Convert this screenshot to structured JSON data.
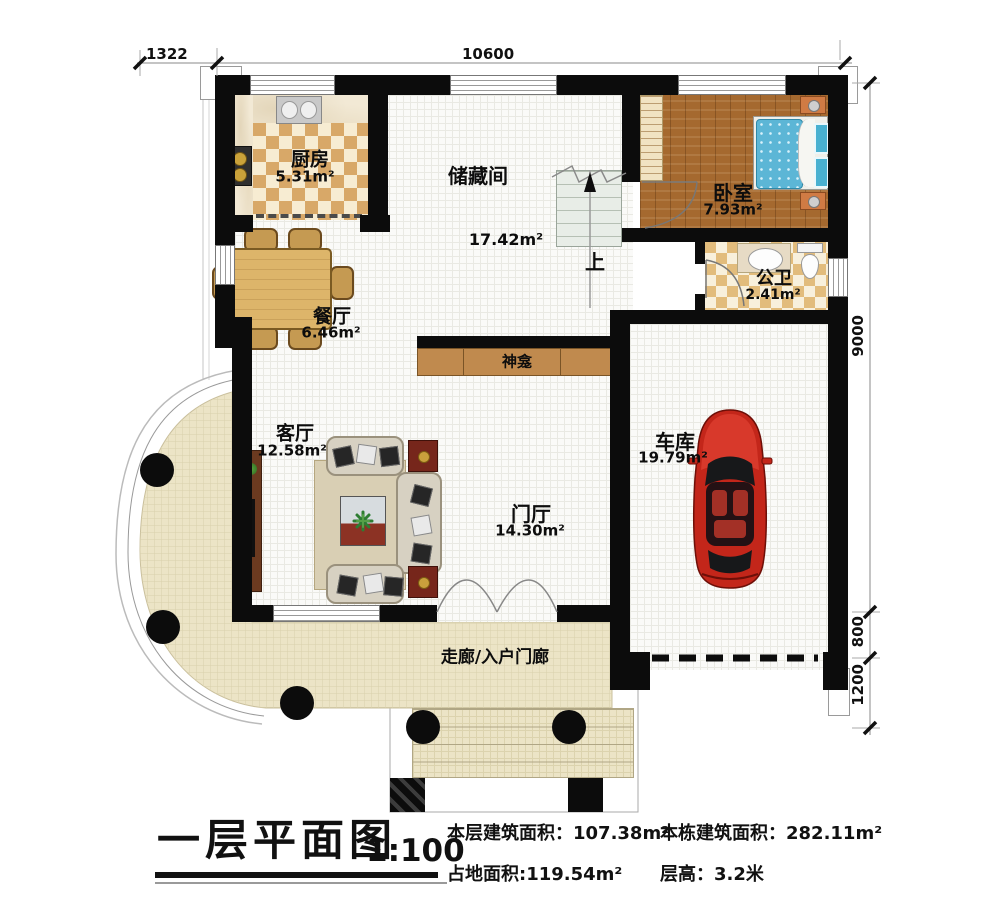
{
  "palette": {
    "wall": "#0c0c0c",
    "car_red": "#c3261a",
    "wood_floor": "#a5692f",
    "porch_cream": "#ece4c6",
    "kitchen_checker": "#d8a868",
    "bed_blue": "#5cb6d6"
  },
  "dimensions": {
    "left_top": "1322",
    "top": "10600",
    "right_main": "9000",
    "right_mid": "800",
    "right_bottom": "1200"
  },
  "rooms": {
    "kitchen": {
      "name": "厨房",
      "area": "5.31m²"
    },
    "storage": {
      "name": "储藏间",
      "area": "17.42m²"
    },
    "bedroom": {
      "name": "卧室",
      "area": "7.93m²"
    },
    "bathroom": {
      "name": "公卫",
      "area": "2.41m²"
    },
    "dining": {
      "name": "餐厅",
      "area": "6.46m²"
    },
    "living": {
      "name": "客厅",
      "area": "12.58m²"
    },
    "foyer": {
      "name": "门厅",
      "area": "14.30m²"
    },
    "garage": {
      "name": "车库",
      "area": "19.79m²"
    },
    "shrine": {
      "name": "神龛"
    },
    "porch": {
      "name": "走廊/入户门廊"
    },
    "stairs": {
      "up": "上"
    }
  },
  "title_block": {
    "title": "一层平面图",
    "scale": "1:100",
    "stats": [
      {
        "label": "本层建筑面积：",
        "value": "107.38m²"
      },
      {
        "label": "本栋建筑面积：",
        "value": "282.11m²"
      },
      {
        "label": "占地面积:",
        "value": "119.54m²"
      },
      {
        "label": "层高：",
        "value": "3.2米"
      }
    ]
  }
}
